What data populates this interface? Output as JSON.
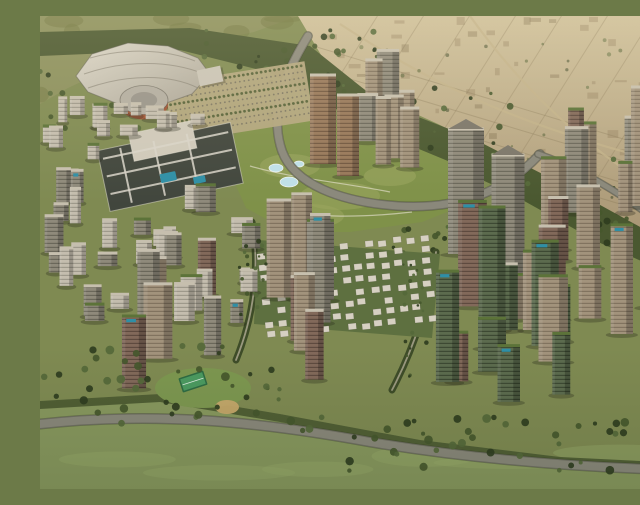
{
  "scene": {
    "width": 640,
    "height": 473,
    "title": "Aerial rendering of a planned city district with arena, central park, villa grid and high-rise clusters"
  },
  "palette": {
    "base": "#7f8a52",
    "desert_top": "#cdbf9a",
    "desert_bottom": "#a69372",
    "hills": "#8a8f5c",
    "hills_shade": "#70763f",
    "forest": "#4a5830",
    "park": "#7f9149",
    "park_light": "#9aa65e",
    "fields": "#88985e",
    "fields_light": "#9aab6b",
    "road": "#8a887b",
    "road_edge": "#6f6e62",
    "avenue_edge": "#3e4c28",
    "avenue_core": "#9a987f",
    "water": "#bfe0e8",
    "pool": "#2f8fa6",
    "roof_green": "#5c7339",
    "roof_light": "#c6bfae",
    "shadow": "rgba(35,35,22,0.30)",
    "stadium_roof_light": "#dad6c9",
    "stadium_roof_dark": "#aaa496",
    "drum_facade": "#9e5435",
    "drum_top": "#b2ada1",
    "drum_inner": "#98948a",
    "villa": "#d6d0c2",
    "villa_bg": "#5e7040",
    "mall_roof": "#41463d",
    "mall_roof_light": "#cfc9ba",
    "mall_frame": "#d8d4c8",
    "lawn": "#7d9750",
    "tennis_outer": "#2e6b43",
    "tennis_inner": "#4b9a60",
    "playground": "#c8a96c",
    "parking_base": "#b3a67e",
    "parking_dot": "#75705f",
    "desert_line": "#8d7d5c",
    "desert_road": "#c2b28a",
    "plot_dark": "rgba(110,92,64,0.30)",
    "plot_light": "rgba(140,120,88,0.35)"
  },
  "facades": {
    "gray": {
      "base": "#8f8a7b",
      "stripe": "rgba(45,45,38,0.38)"
    },
    "tan": {
      "base": "#a2937c",
      "stripe": "rgba(70,55,40,0.35)"
    },
    "brown": {
      "base": "#82695a",
      "stripe": "rgba(40,28,22,0.40)"
    },
    "bronze": {
      "base": "#97785a",
      "stripe": "rgba(55,38,25,0.40)"
    },
    "light": {
      "base": "#c4bdae",
      "stripe": "rgba(85,85,75,0.35)"
    },
    "greenglass": {
      "base": "#5c6b4e",
      "stripe": "rgba(22,30,18,0.45)"
    }
  },
  "terrain": {
    "desert": {
      "points": [
        [
          258,
          0
        ],
        [
          640,
          0
        ],
        [
          640,
          236
        ],
        [
          562,
          196
        ],
        [
          478,
          148
        ],
        [
          398,
          108
        ],
        [
          328,
          76
        ],
        [
          284,
          44
        ]
      ]
    },
    "hills": {
      "points": [
        [
          0,
          0
        ],
        [
          258,
          0
        ],
        [
          214,
          16
        ],
        [
          150,
          30
        ],
        [
          84,
          46
        ],
        [
          28,
          72
        ],
        [
          0,
          88
        ]
      ]
    },
    "forest_band": {
      "points": [
        [
          0,
          16
        ],
        [
          150,
          12
        ],
        [
          270,
          30
        ],
        [
          340,
          86
        ],
        [
          432,
          122
        ],
        [
          522,
          168
        ],
        [
          602,
          212
        ],
        [
          640,
          242
        ],
        [
          640,
          262
        ],
        [
          558,
          226
        ],
        [
          468,
          176
        ],
        [
          378,
          134
        ],
        [
          298,
          94
        ],
        [
          228,
          56
        ],
        [
          140,
          34
        ],
        [
          0,
          40
        ]
      ]
    },
    "park": {
      "points": [
        [
          195,
          118
        ],
        [
          252,
          100
        ],
        [
          312,
          108
        ],
        [
          362,
          126
        ],
        [
          420,
          150
        ],
        [
          432,
          186
        ],
        [
          382,
          206
        ],
        [
          310,
          216
        ],
        [
          250,
          216
        ],
        [
          206,
          192
        ],
        [
          188,
          152
        ]
      ]
    },
    "fields": {
      "points": [
        [
          0,
          385
        ],
        [
          120,
          378
        ],
        [
          240,
          398
        ],
        [
          380,
          424
        ],
        [
          520,
          441
        ],
        [
          640,
          447
        ],
        [
          640,
          473
        ],
        [
          0,
          473
        ]
      ]
    },
    "south_tree_line": {
      "points": [
        [
          0,
          385
        ],
        [
          120,
          378
        ],
        [
          240,
          398
        ],
        [
          380,
          424
        ],
        [
          520,
          441
        ],
        [
          640,
          447
        ],
        [
          640,
          455
        ],
        [
          520,
          449
        ],
        [
          380,
          432
        ],
        [
          240,
          406
        ],
        [
          120,
          386
        ],
        [
          0,
          393
        ]
      ]
    }
  },
  "desert_texture": {
    "seed": 5,
    "lineStep": 22,
    "crossStep": 46,
    "plots": 70
  },
  "desert_roads": [
    "M 300,8 C 380,60 470,110 640,150",
    "M 430,0 C 480,70 545,135 640,188"
  ],
  "roads": [
    {
      "name": "loop-road",
      "d": "M 268,20 C 242,62 230,100 242,135 C 254,168 300,186 358,190 C 425,194 468,172 500,138",
      "w": 7,
      "kind": "main"
    },
    {
      "name": "east-link-road",
      "d": "M 498,138 C 534,150 572,172 608,198",
      "w": 5,
      "kind": "main"
    },
    {
      "name": "south-road",
      "d": "M 0,408 C 110,396 210,404 330,426 C 450,446 560,452 640,454",
      "w": 8,
      "kind": "main"
    },
    {
      "name": "west-avenue",
      "d": "M 212,206 C 220,252 214,300 196,344",
      "w": 4,
      "kind": "avenue"
    },
    {
      "name": "mid-avenue",
      "d": "M 396,236 C 390,284 374,332 352,374",
      "w": 4,
      "kind": "avenue"
    }
  ],
  "park_patches": [
    [
      250,
      150,
      30,
      12
    ],
    [
      300,
      180,
      40,
      14
    ],
    [
      350,
      160,
      26,
      10
    ],
    [
      270,
      200,
      34,
      12
    ]
  ],
  "park_paths": [
    "M 210,150 C 250,162 300,166 350,176",
    "M 228,192 C 268,202 320,202 372,196"
  ],
  "water_features": [
    [
      236,
      152,
      7,
      4
    ],
    [
      249,
      166,
      9,
      5
    ],
    [
      259,
      148,
      5,
      3
    ]
  ],
  "stadium": {
    "roof": [
      [
        36,
        60
      ],
      [
        52,
        38
      ],
      [
        88,
        27
      ],
      [
        128,
        30
      ],
      [
        158,
        42
      ],
      [
        170,
        58
      ],
      [
        152,
        78
      ],
      [
        118,
        90
      ],
      [
        78,
        88
      ],
      [
        48,
        76
      ]
    ],
    "ridges": [
      "M 50,42 C 85,32 125,33 155,45",
      "M 44,58 C 85,44 130,44 164,58",
      "M 48,72 C 88,58 130,58 158,72"
    ],
    "annex": {
      "x": 158,
      "y": 52,
      "w": 24,
      "h": 16,
      "rot": -12
    },
    "drum": {
      "cx": 104,
      "cy": 84,
      "rx": 24,
      "ry": 14.5
    }
  },
  "parking": [
    {
      "x": 128,
      "y": 56,
      "w": 142,
      "h": 60,
      "rot": -9
    }
  ],
  "mall": {
    "rot": -12,
    "cx": 130,
    "cy": 150,
    "blocks": [
      {
        "x": 62,
        "y": 120,
        "w": 136,
        "h": 62,
        "fill": "mall_roof"
      },
      {
        "x": 96,
        "y": 110,
        "w": 64,
        "h": 28,
        "fill": "mall_roof_light"
      }
    ],
    "frames": [
      [
        66,
        128,
        128,
        2
      ],
      [
        66,
        146,
        128,
        2
      ],
      [
        66,
        164,
        128,
        2
      ],
      [
        84,
        122,
        2,
        56
      ],
      [
        118,
        122,
        2,
        56
      ],
      [
        152,
        122,
        2,
        56
      ]
    ],
    "pools": [
      [
        118,
        156,
        16,
        9
      ],
      [
        150,
        166,
        12,
        7
      ]
    ]
  },
  "villas": {
    "seed": 91,
    "x": 222,
    "y": 228,
    "cols": 13,
    "rows": 8,
    "dx": 13.5,
    "dy": 11.5,
    "w": 8,
    "h": 6,
    "skip": 0.2,
    "rot": -6,
    "bg": [
      [
        218,
        224
      ],
      [
        400,
        238
      ],
      [
        392,
        322
      ],
      [
        214,
        308
      ]
    ]
  },
  "landmarks": [
    {
      "name": "gateway-tower-1",
      "x": 426,
      "y": 238,
      "w": 36,
      "h": 124,
      "type": "gray",
      "apex": true
    },
    {
      "name": "gateway-tower-2",
      "x": 468,
      "y": 260,
      "w": 33,
      "h": 120,
      "type": "gray",
      "apex": true
    },
    {
      "name": "green-spine-tower",
      "x": 452,
      "y": 332,
      "w": 27,
      "h": 140,
      "type": "greenglass",
      "roofGreen": true
    },
    {
      "name": "bronze-tower-1",
      "x": 283,
      "y": 148,
      "w": 26,
      "h": 88,
      "type": "bronze"
    },
    {
      "name": "bronze-tower-2",
      "x": 308,
      "y": 160,
      "w": 22,
      "h": 80,
      "type": "bronze"
    },
    {
      "name": "east-edge-tower-1",
      "x": 604,
      "y": 190,
      "w": 26,
      "h": 118,
      "type": "tan"
    },
    {
      "name": "east-edge-tower-2",
      "x": 631,
      "y": 206,
      "w": 22,
      "h": 104,
      "type": "tan"
    }
  ],
  "clusters": [
    {
      "name": "west-lowrise",
      "seed": 77,
      "area": [
        56,
        96,
        150,
        26
      ],
      "count": 8,
      "types": [
        "light"
      ],
      "w": [
        10,
        20
      ],
      "h": [
        8,
        18
      ],
      "roofGreenP": 0.2,
      "poolP": 0
    },
    {
      "name": "northwest-infill",
      "seed": 73,
      "area": [
        0,
        96,
        68,
        82
      ],
      "count": 8,
      "types": [
        "light"
      ],
      "w": [
        8,
        16
      ],
      "h": [
        10,
        24
      ],
      "roofGreenP": 0.2,
      "poolP": 0
    },
    {
      "name": "west-district",
      "seed": 67,
      "area": [
        2,
        185,
        222,
        122
      ],
      "count": 30,
      "types": [
        "light",
        "gray"
      ],
      "w": [
        10,
        22
      ],
      "h": [
        12,
        38
      ],
      "roofGreenP": 0.3,
      "poolP": 0.12
    },
    {
      "name": "uptown-arc",
      "seed": 11,
      "area": [
        300,
        102,
        118,
        84
      ],
      "count": 7,
      "types": [
        "gray",
        "tan"
      ],
      "w": [
        14,
        24
      ],
      "h": [
        40,
        75
      ],
      "roofGreenP": 0.15,
      "poolP": 0
    },
    {
      "name": "east-ridge",
      "seed": 23,
      "area": [
        500,
        168,
        138,
        92
      ],
      "count": 11,
      "types": [
        "tan",
        "gray",
        "brown"
      ],
      "w": [
        13,
        26
      ],
      "h": [
        45,
        100
      ],
      "roofGreenP": 0.35,
      "poolP": 0.1
    },
    {
      "name": "east-village",
      "seed": 37,
      "area": [
        390,
        258,
        248,
        146
      ],
      "count": 18,
      "types": [
        "greenglass",
        "brown",
        "tan"
      ],
      "w": [
        16,
        30
      ],
      "h": [
        40,
        110
      ],
      "roofGreenP": 0.7,
      "poolP": 0.35
    },
    {
      "name": "southwest-cluster",
      "seed": 51,
      "area": [
        72,
        268,
        226,
        122
      ],
      "count": 13,
      "types": [
        "brown",
        "tan",
        "gray"
      ],
      "w": [
        16,
        30
      ],
      "h": [
        50,
        112
      ],
      "roofGreenP": 0.25,
      "poolP": 0.1
    }
  ],
  "amenities": {
    "lawn": {
      "cx": 163,
      "cy": 372,
      "rx": 48,
      "ry": 20
    },
    "tennis": {
      "x": 140,
      "y": 358,
      "w": 26,
      "h": 15,
      "rot": -18
    },
    "playground": {
      "cx": 187,
      "cy": 391,
      "rx": 12,
      "ry": 7
    }
  },
  "tree_scatters_early": [
    {
      "name": "stadium-grove",
      "seed": 3,
      "area": [
        0,
        55,
        145,
        60
      ],
      "count": 26,
      "r": [
        1.5,
        3.5
      ]
    },
    {
      "name": "north-belt-1",
      "seed": 4,
      "area": [
        150,
        14,
        200,
        58
      ],
      "count": 40,
      "r": [
        1.5,
        3.5
      ]
    },
    {
      "name": "north-belt-2",
      "seed": 6,
      "area": [
        300,
        72,
        180,
        68
      ],
      "count": 34,
      "r": [
        1.5,
        3.5
      ]
    },
    {
      "name": "north-belt-3",
      "seed": 7,
      "area": [
        460,
        142,
        180,
        88
      ],
      "count": 34,
      "r": [
        1.5,
        3.5
      ]
    },
    {
      "name": "park-north-grove",
      "seed": 8,
      "area": [
        182,
        96,
        120,
        58
      ],
      "count": 24,
      "r": [
        1.5,
        3.2
      ]
    },
    {
      "name": "park-south-grove",
      "seed": 9,
      "area": [
        330,
        182,
        118,
        58
      ],
      "count": 20,
      "r": [
        1.5,
        3.2
      ]
    },
    {
      "name": "desert-scrub",
      "seed": 17,
      "area": [
        300,
        20,
        335,
        175
      ],
      "count": 30,
      "r": [
        1,
        2.2
      ],
      "faint": true
    }
  ],
  "tree_scatters_late": [
    {
      "name": "west-avenue-trees",
      "seed": 12,
      "area": [
        198,
        222,
        28,
        108
      ],
      "count": 18,
      "r": [
        1.2,
        2.6
      ]
    },
    {
      "name": "mid-avenue-trees",
      "seed": 13,
      "area": [
        362,
        244,
        28,
        126
      ],
      "count": 18,
      "r": [
        1.2,
        2.6
      ]
    },
    {
      "name": "southwest-forest",
      "seed": 14,
      "area": [
        0,
        330,
        240,
        78
      ],
      "count": 42,
      "r": [
        2,
        4.5
      ]
    },
    {
      "name": "south-belt",
      "seed": 16,
      "area": [
        220,
        398,
        420,
        58
      ],
      "count": 46,
      "r": [
        2,
        4.5
      ]
    }
  ],
  "fields_streaks": {
    "seed": 21,
    "count": 6
  },
  "tree_colors": [
    "#2f3d1f",
    "#45572c",
    "#55683a"
  ]
}
